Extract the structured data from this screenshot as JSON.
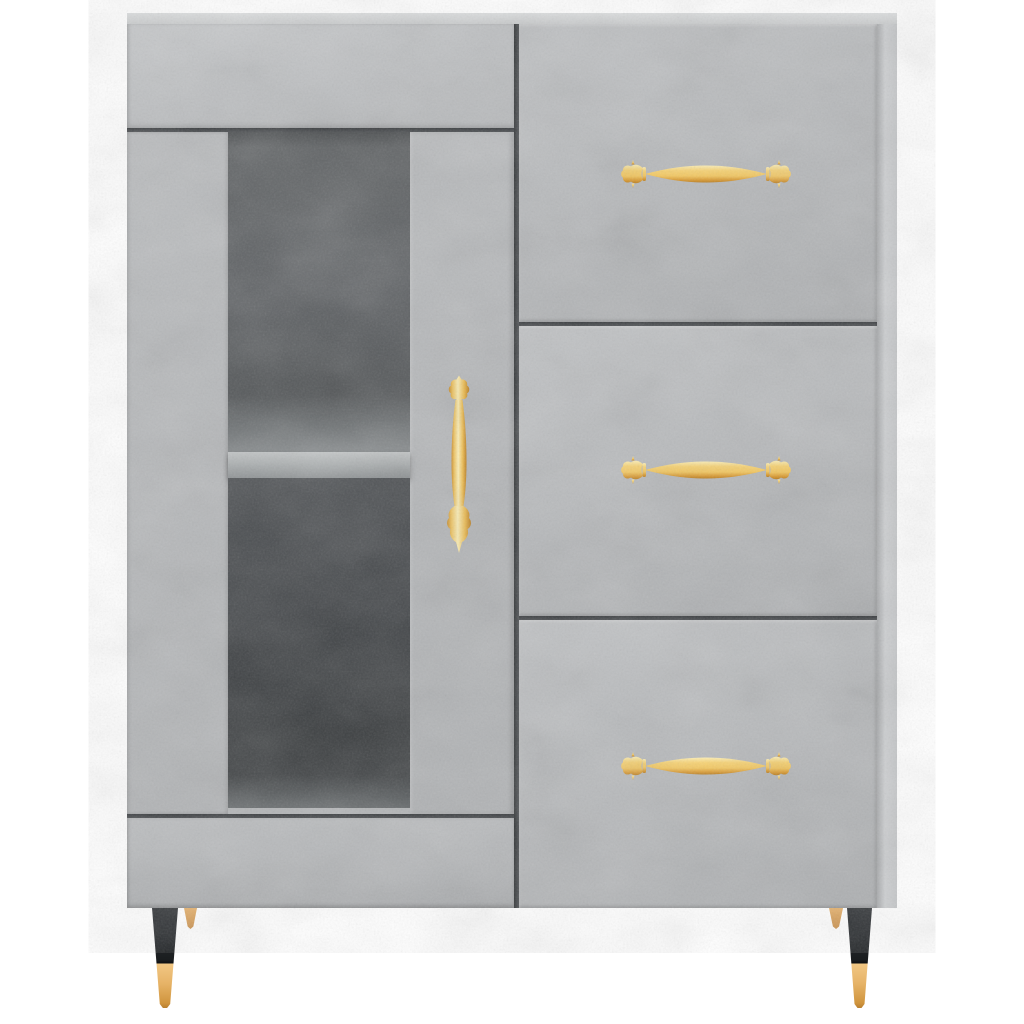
{
  "meta": {
    "domain": "product-photo",
    "subject": "Concrete grey sideboard with glass display door, three drawers, ornate gold handles and tapered black metal legs with brass tips",
    "background_color": "#ffffff"
  },
  "colors": {
    "bg": "#ffffff",
    "concrete": "#b7b9bb",
    "concrete-light": "#c6c8ca",
    "concrete-dark": "#a9abad",
    "concrete-lip": "#dcdedf",
    "concrete-side": "#cdcfd1",
    "seam": "#4a4d50",
    "glass-top": "#616466",
    "glass-mid": "#55585a",
    "glass-dark": "#3a3d3f",
    "glass-floor": "#5a5e60",
    "shelf-face": "#adb1b2",
    "shelf-deep": "#888c8e",
    "gold": "#f3c75f",
    "gold-light": "#fceeb4",
    "gold-dark": "#ba7d1e",
    "leg-black": "#34373a",
    "leg-black-deep": "#0e1012",
    "leg-brass": "#f1c783",
    "leg-brass-dark": "#d0953e",
    "leg-wood": "#e5b26f",
    "leg-wood-dark": "#cc9350"
  },
  "cabinet": {
    "label": "concrete-grey sideboard",
    "left_section": {
      "top_panel": "concrete top panel",
      "door": {
        "type": "glass display door",
        "glass": "dark tinted glass window",
        "shelf": "interior shelf",
        "handle": "vertical ornate gold handle"
      },
      "bottom_panel": "concrete bottom rail"
    },
    "right_section": {
      "drawers": [
        {
          "label": "top drawer",
          "handle": "ornate gold bar handle"
        },
        {
          "label": "middle drawer",
          "handle": "ornate gold bar handle"
        },
        {
          "label": "bottom drawer",
          "handle": "ornate gold bar handle"
        }
      ]
    },
    "legs": {
      "front": "tapered black metal leg with brass tip",
      "rear": "tapered wooden leg"
    }
  }
}
